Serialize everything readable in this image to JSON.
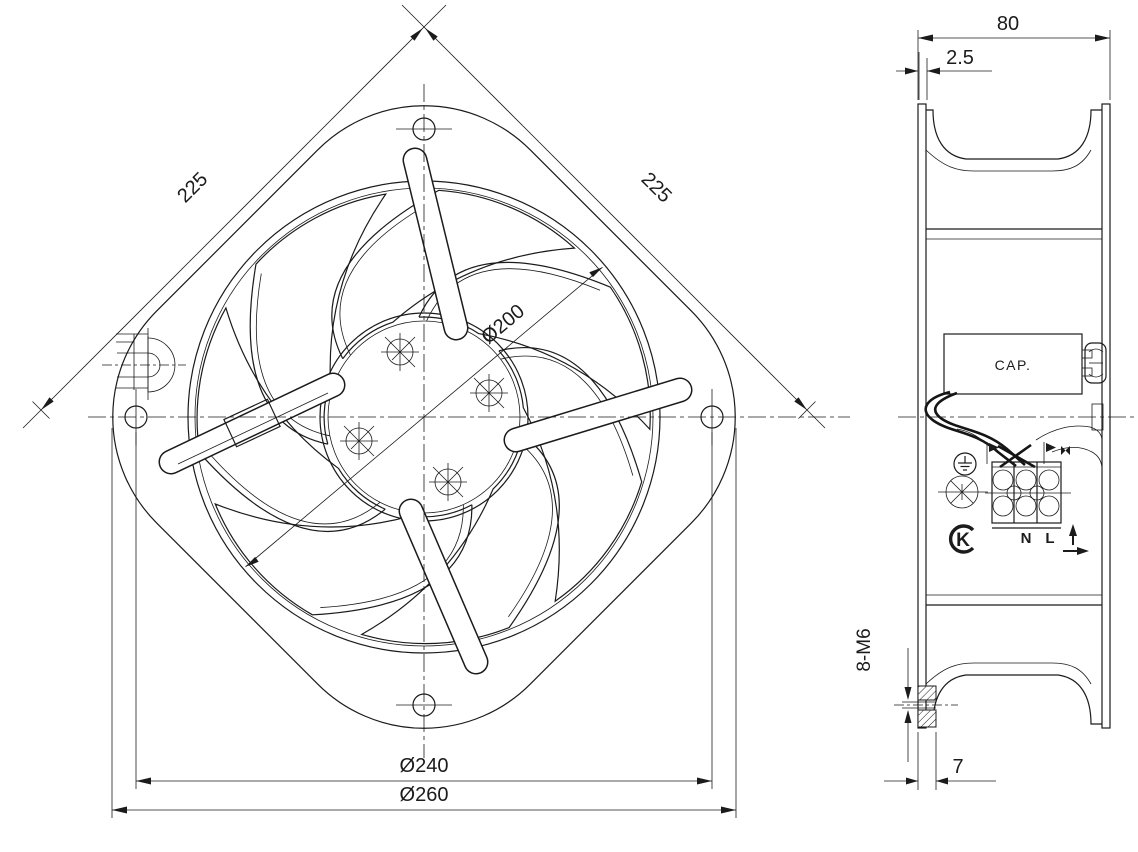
{
  "drawing_title": "axial-fan-two-view-technical-drawing",
  "colors": {
    "line": "#1b1b1b",
    "background": "#ffffff"
  },
  "front_view": {
    "dim_side_top_left": "225",
    "dim_side_top_right": "225",
    "dim_impeller_diameter": "Ø200",
    "dim_bolt_circle_diameter": "Ø240",
    "dim_flange_diameter": "Ø260"
  },
  "side_view": {
    "dim_depth": "80",
    "dim_wall_thickness": "2.5",
    "dim_mounting_holes": "8-M6",
    "dim_flange_thickness": "7",
    "capacitor_label": "CAP.",
    "terminal": {
      "neutral": "N",
      "live": "L"
    },
    "certification_mark": "K"
  },
  "icons": {
    "ground_symbol": "circle-with-earth-ground-glyph",
    "rotation_symbol": "circle-with-diagonal-cross",
    "certification_logo": "bold-K-in-open-circle",
    "airflow_up_arrow": "up-arrow",
    "airflow_right_arrow": "right-arrow",
    "wire_clamp": "small-filled-right-triangles"
  }
}
